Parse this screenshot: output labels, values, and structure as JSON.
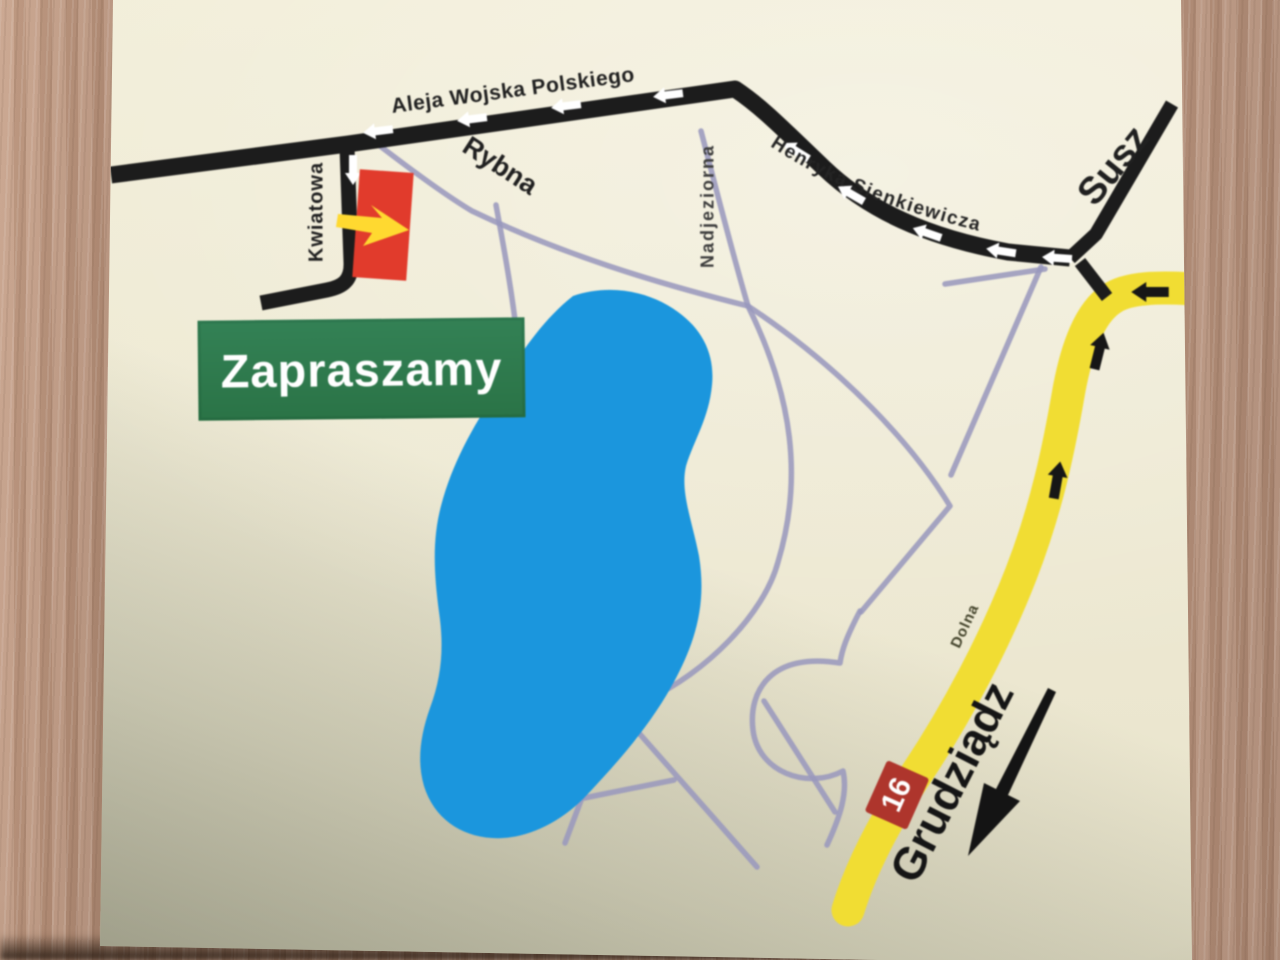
{
  "map": {
    "banner": {
      "label": "Zapraszamy"
    },
    "streets": {
      "aleja_wojska_polskiego": "Aleja Wojska Polskiego",
      "rybna": "Rybna",
      "kwiatowa": "Kwiatowa",
      "nadjeziorna": "Nadjeziorna",
      "henryka_sienkiewicza": "Henryka Sienkiewicza",
      "dolna": "Dolna"
    },
    "directions": {
      "susz": "Susz",
      "grudziadz": "Grudziądz"
    },
    "route_badge": {
      "number": "16"
    },
    "colors": {
      "paper": "#f2eed9",
      "major_road": "#1c1c1c",
      "minor_road": "#9a98bd",
      "route_16_road": "#f1dd33",
      "lake": "#1b96dd",
      "banner_green": "#2f7b4c",
      "building_red": "#e13b2c",
      "badge_red": "#ae352c",
      "arrow_yellow": "#ffd930",
      "wood_table": "#b5917d"
    }
  }
}
